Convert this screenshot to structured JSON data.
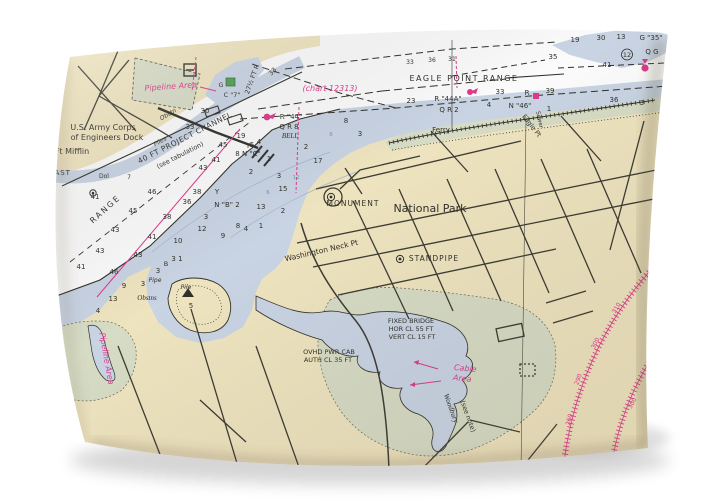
{
  "colors": {
    "ink": "#32322b",
    "magenta": "#e23a8e",
    "blue": "#7d96b5",
    "land": "#f2e7c2",
    "water": "#ccd7e7",
    "marsh": "#dadfc8",
    "road": "#3d3d35",
    "chart_white": "#ffffff",
    "page_bg": "#ffffff"
  },
  "map": {
    "labels": [
      {
        "t": "U.S. Army Corps",
        "x": 103,
        "y": 130,
        "s": 8
      },
      {
        "t": "of Engineers Dock",
        "x": 107,
        "y": 140,
        "s": 8
      },
      {
        "t": "Ft Mifflin",
        "x": 72,
        "y": 154,
        "s": 8
      },
      {
        "t": "EAST",
        "x": 60,
        "y": 175,
        "s": 7,
        "sp": 1
      },
      {
        "t": "Dol",
        "x": 104,
        "y": 178,
        "s": 6
      },
      {
        "t": "RANGE",
        "x": 107,
        "y": 211,
        "s": 8,
        "r": -42,
        "sp": 2
      },
      {
        "t": "40 FT PROJECT CHANNEL",
        "x": 186,
        "y": 140,
        "s": 7.5,
        "r": -27,
        "sp": 0.5
      },
      {
        "t": "(see tabulation)",
        "x": 181,
        "y": 157,
        "s": 6.5,
        "r": -27
      },
      {
        "t": "27½ FT R",
        "x": 254,
        "y": 80,
        "s": 6.5,
        "r": -70
      },
      {
        "t": "Obstn",
        "x": 169,
        "y": 116,
        "s": 6,
        "r": -30,
        "i": 1
      },
      {
        "t": "Piles",
        "x": 161,
        "y": 143,
        "s": 6,
        "r": -30,
        "i": 1
      },
      {
        "t": "Pipeline Area",
        "x": 171,
        "y": 89,
        "s": 8,
        "c": "magenta",
        "i": 1,
        "r": -4
      },
      {
        "t": "(chart 12313)",
        "x": 330,
        "y": 91,
        "s": 8,
        "c": "magenta",
        "i": 1
      },
      {
        "t": "G",
        "x": 221,
        "y": 87,
        "s": 6.5
      },
      {
        "t": "C \"7\"",
        "x": 232,
        "y": 97,
        "s": 6.5
      },
      {
        "t": "EAGLE POINT RANGE",
        "x": 464,
        "y": 81,
        "s": 8,
        "sp": 1.5
      },
      {
        "t": "33",
        "x": 410,
        "y": 64,
        "s": 6
      },
      {
        "t": "36",
        "x": 432,
        "y": 62,
        "s": 6
      },
      {
        "t": "31",
        "x": 452,
        "y": 61,
        "s": 6
      },
      {
        "t": "R \"44\"",
        "x": 291,
        "y": 119,
        "s": 7
      },
      {
        "t": "Q R 8",
        "x": 289,
        "y": 129,
        "s": 7
      },
      {
        "t": "BELL",
        "x": 290,
        "y": 138,
        "s": 7,
        "i": 1,
        "f": 1
      },
      {
        "t": "R \"44A\"",
        "x": 448,
        "y": 101,
        "s": 7
      },
      {
        "t": "Q R 2",
        "x": 449,
        "y": 112,
        "s": 7
      },
      {
        "t": "R",
        "x": 527,
        "y": 95,
        "s": 7
      },
      {
        "t": "39",
        "x": 550,
        "y": 93,
        "s": 7
      },
      {
        "t": "N \"46\"",
        "x": 520,
        "y": 108,
        "s": 7
      },
      {
        "t": "Ferry",
        "x": 441,
        "y": 132,
        "s": 7
      },
      {
        "t": "Eagle Pt",
        "x": 530,
        "y": 127,
        "s": 6.5,
        "r": 52
      },
      {
        "t": "Sewer",
        "x": 538,
        "y": 120,
        "s": 5.5,
        "r": 78
      },
      {
        "t": "MONUMENT",
        "x": 353,
        "y": 206,
        "s": 7.5,
        "sp": 1
      },
      {
        "t": "National Park",
        "x": 430,
        "y": 212,
        "s": 11
      },
      {
        "t": "Washington Neck Pt",
        "x": 322,
        "y": 253,
        "s": 7.5,
        "r": -13
      },
      {
        "t": "STANDPIPE",
        "x": 434,
        "y": 261,
        "s": 7.5,
        "sp": 1
      },
      {
        "t": "FIXED BRIDGE",
        "x": 411,
        "y": 323,
        "s": 6.5
      },
      {
        "t": "HOR CL 55 FT",
        "x": 411,
        "y": 331,
        "s": 6.5
      },
      {
        "t": "VERT CL 15 FT",
        "x": 412,
        "y": 339,
        "s": 6.5
      },
      {
        "t": "OVHD PWR CAB",
        "x": 329,
        "y": 354,
        "s": 6.5
      },
      {
        "t": "AUTH CL 35 FT",
        "x": 328,
        "y": 362,
        "s": 6.5
      },
      {
        "t": "Cable",
        "x": 465,
        "y": 371,
        "s": 8,
        "c": "magenta",
        "i": 1,
        "r": 6
      },
      {
        "t": "Area",
        "x": 462,
        "y": 381,
        "s": 8,
        "c": "magenta",
        "i": 1,
        "r": 6
      },
      {
        "t": "Woodbury",
        "x": 449,
        "y": 409,
        "s": 7.5,
        "r": 70,
        "i": 1,
        "f": 1
      },
      {
        "t": "(see note)",
        "x": 466,
        "y": 417,
        "s": 6.5,
        "r": 70
      },
      {
        "t": "Pipeline Area",
        "x": 104,
        "y": 359,
        "s": 8,
        "c": "magenta",
        "i": 1,
        "r": 80
      },
      {
        "t": "Obstns",
        "x": 147,
        "y": 300,
        "s": 7,
        "i": 1,
        "f": 1
      },
      {
        "t": "Pipe",
        "x": 155,
        "y": 282,
        "s": 6,
        "i": 1
      },
      {
        "t": "Pile",
        "x": 186,
        "y": 289,
        "s": 6,
        "i": 1
      },
      {
        "t": "G \"35\"",
        "x": 651,
        "y": 40,
        "s": 7
      },
      {
        "t": "Q G",
        "x": 652,
        "y": 54,
        "s": 7
      },
      {
        "t": "12",
        "x": 627,
        "y": 57,
        "s": 6.5
      },
      {
        "t": "19",
        "x": 575,
        "y": 42,
        "s": 7
      },
      {
        "t": "30",
        "x": 601,
        "y": 40,
        "s": 7
      },
      {
        "t": "13",
        "x": 621,
        "y": 39,
        "s": 7
      },
      {
        "t": "35",
        "x": 553,
        "y": 59,
        "s": 7
      },
      {
        "t": "41",
        "x": 607,
        "y": 67,
        "s": 7
      },
      {
        "t": "41",
        "x": 95,
        "y": 199,
        "s": 7
      },
      {
        "t": "43",
        "x": 115,
        "y": 232,
        "s": 7
      },
      {
        "t": "45",
        "x": 133,
        "y": 213,
        "s": 7
      },
      {
        "t": "46",
        "x": 152,
        "y": 194,
        "s": 7
      },
      {
        "t": "38",
        "x": 167,
        "y": 219,
        "s": 7
      },
      {
        "t": "41",
        "x": 152,
        "y": 239,
        "s": 7
      },
      {
        "t": "43",
        "x": 138,
        "y": 257,
        "s": 7
      },
      {
        "t": "36",
        "x": 187,
        "y": 204,
        "s": 7
      },
      {
        "t": "38",
        "x": 197,
        "y": 194,
        "s": 7
      },
      {
        "t": "41",
        "x": 81,
        "y": 269,
        "s": 7
      },
      {
        "t": "43",
        "x": 100,
        "y": 253,
        "s": 7
      },
      {
        "t": "46",
        "x": 114,
        "y": 274,
        "s": 7
      },
      {
        "t": "9",
        "x": 124,
        "y": 288,
        "s": 7
      },
      {
        "t": "13",
        "x": 113,
        "y": 301,
        "s": 7
      },
      {
        "t": "3",
        "x": 143,
        "y": 286,
        "s": 7
      },
      {
        "t": "4",
        "x": 98,
        "y": 313,
        "s": 7
      },
      {
        "t": "30",
        "x": 205,
        "y": 113,
        "s": 7
      },
      {
        "t": "33",
        "x": 190,
        "y": 129,
        "s": 7
      },
      {
        "t": "33",
        "x": 274,
        "y": 73,
        "s": 6.5,
        "r": -45
      },
      {
        "t": "7",
        "x": 129,
        "y": 179,
        "s": 6
      },
      {
        "t": "10",
        "x": 178,
        "y": 243,
        "s": 7
      },
      {
        "t": "12",
        "x": 202,
        "y": 231,
        "s": 7
      },
      {
        "t": "9",
        "x": 223,
        "y": 238,
        "s": 7
      },
      {
        "t": "Y",
        "x": 217,
        "y": 194,
        "s": 7
      },
      {
        "t": "N \"B\" 2",
        "x": 227,
        "y": 207,
        "s": 7
      },
      {
        "t": "3",
        "x": 206,
        "y": 219,
        "s": 7
      },
      {
        "t": "8",
        "x": 238,
        "y": 228,
        "s": 7
      },
      {
        "t": "4",
        "x": 246,
        "y": 231,
        "s": 7
      },
      {
        "t": "1",
        "x": 261,
        "y": 228,
        "s": 7
      },
      {
        "t": "2",
        "x": 251,
        "y": 174,
        "s": 7
      },
      {
        "t": "3",
        "x": 279,
        "y": 178,
        "s": 7
      },
      {
        "t": "15",
        "x": 283,
        "y": 191,
        "s": 7
      },
      {
        "t": "13",
        "x": 261,
        "y": 209,
        "s": 7
      },
      {
        "t": "2",
        "x": 283,
        "y": 213,
        "s": 7
      },
      {
        "t": "17",
        "x": 318,
        "y": 163,
        "s": 7
      },
      {
        "t": "2",
        "x": 306,
        "y": 149,
        "s": 7
      },
      {
        "t": "3",
        "x": 158,
        "y": 273,
        "s": 7
      },
      {
        "t": "B",
        "x": 166,
        "y": 266,
        "s": 6.5
      },
      {
        "t": "3 1",
        "x": 177,
        "y": 261,
        "s": 7
      },
      {
        "t": "5",
        "x": 191,
        "y": 308,
        "s": 7
      },
      {
        "t": "19",
        "x": 241,
        "y": 138,
        "s": 7
      },
      {
        "t": "Y",
        "x": 248,
        "y": 148,
        "s": 7
      },
      {
        "t": "5",
        "x": 252,
        "y": 147,
        "s": 7
      },
      {
        "t": "4",
        "x": 259,
        "y": 144,
        "s": 7
      },
      {
        "t": "8 N \"C\"",
        "x": 248,
        "y": 156,
        "s": 7
      },
      {
        "t": "1",
        "x": 269,
        "y": 161,
        "s": 7
      },
      {
        "t": "45",
        "x": 223,
        "y": 147,
        "s": 7
      },
      {
        "t": "41",
        "x": 216,
        "y": 162,
        "s": 7
      },
      {
        "t": "43",
        "x": 203,
        "y": 170,
        "s": 7
      },
      {
        "t": "8",
        "x": 346,
        "y": 123,
        "s": 7
      },
      {
        "t": "3",
        "x": 360,
        "y": 136,
        "s": 7
      },
      {
        "t": "23",
        "x": 411,
        "y": 103,
        "s": 7
      },
      {
        "t": "33",
        "x": 500,
        "y": 94,
        "s": 7
      },
      {
        "t": "4",
        "x": 489,
        "y": 107,
        "s": 7
      },
      {
        "t": "1",
        "x": 549,
        "y": 111,
        "s": 7
      },
      {
        "t": "36",
        "x": 614,
        "y": 102,
        "s": 7
      },
      {
        "t": "3",
        "x": 642,
        "y": 105,
        "s": 7
      },
      {
        "t": "6",
        "x": 268,
        "y": 194,
        "s": 5.5,
        "c": "blue"
      },
      {
        "t": "12",
        "x": 296,
        "y": 179,
        "s": 5.5,
        "c": "blue"
      },
      {
        "t": "6",
        "x": 331,
        "y": 136,
        "s": 5.5,
        "c": "blue"
      },
      {
        "t": "310",
        "x": 618,
        "y": 309,
        "s": 6,
        "c": "magenta",
        "r": -58
      },
      {
        "t": "300",
        "x": 597,
        "y": 344,
        "s": 6,
        "c": "magenta",
        "r": -64
      },
      {
        "t": "290",
        "x": 580,
        "y": 380,
        "s": 6,
        "c": "magenta",
        "r": -70
      },
      {
        "t": "260",
        "x": 571,
        "y": 420,
        "s": 6,
        "c": "magenta",
        "r": -76
      },
      {
        "t": "300",
        "x": 634,
        "y": 404,
        "s": 6,
        "c": "magenta",
        "r": -62
      }
    ]
  }
}
